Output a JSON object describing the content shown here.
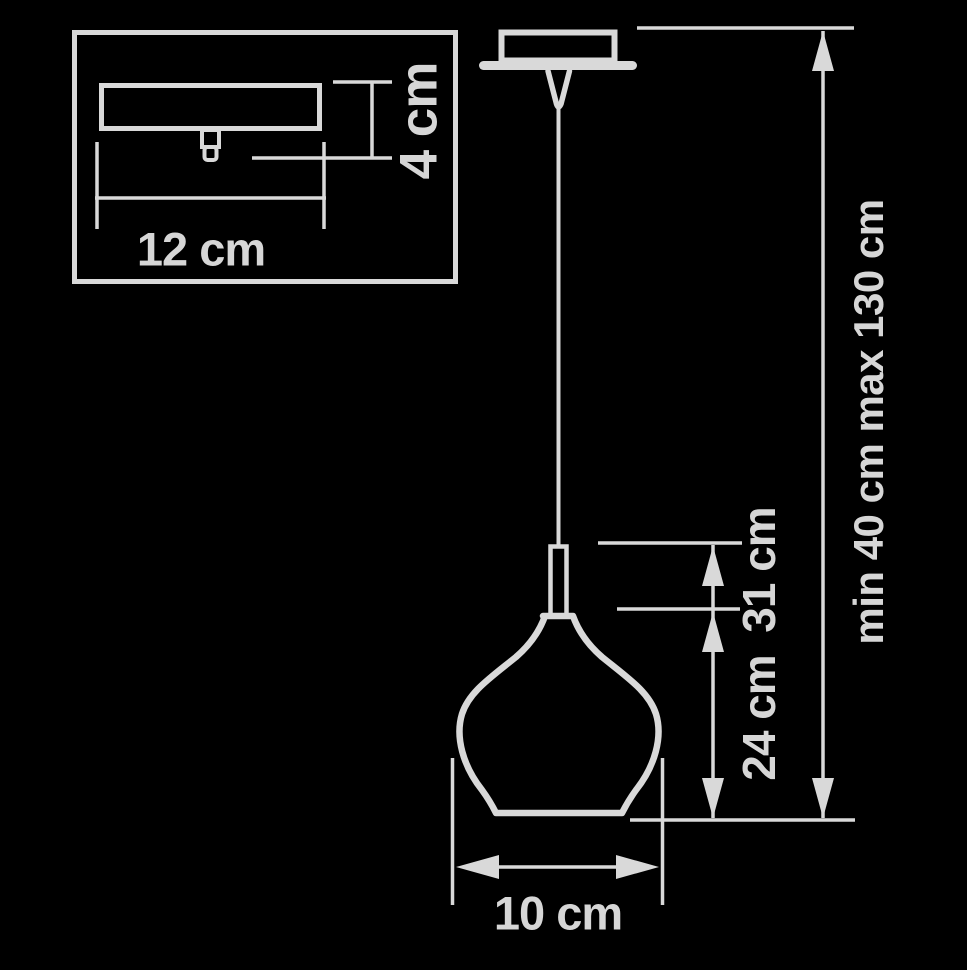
{
  "diagram_title": "pendant-lamp-dimension-diagram",
  "colors": {
    "background": "#000000",
    "line": "#d9d9d9",
    "text": "#d6d6d6"
  },
  "inset": {
    "mount_width_label": "12 cm",
    "mount_height_label": "4 cm"
  },
  "dimensions": {
    "shade_diameter_label": "10 cm",
    "shade_height_label": "24 cm",
    "fixture_height_label": "31 cm",
    "suspension_length_label": "min 40 cm max 130 cm"
  }
}
